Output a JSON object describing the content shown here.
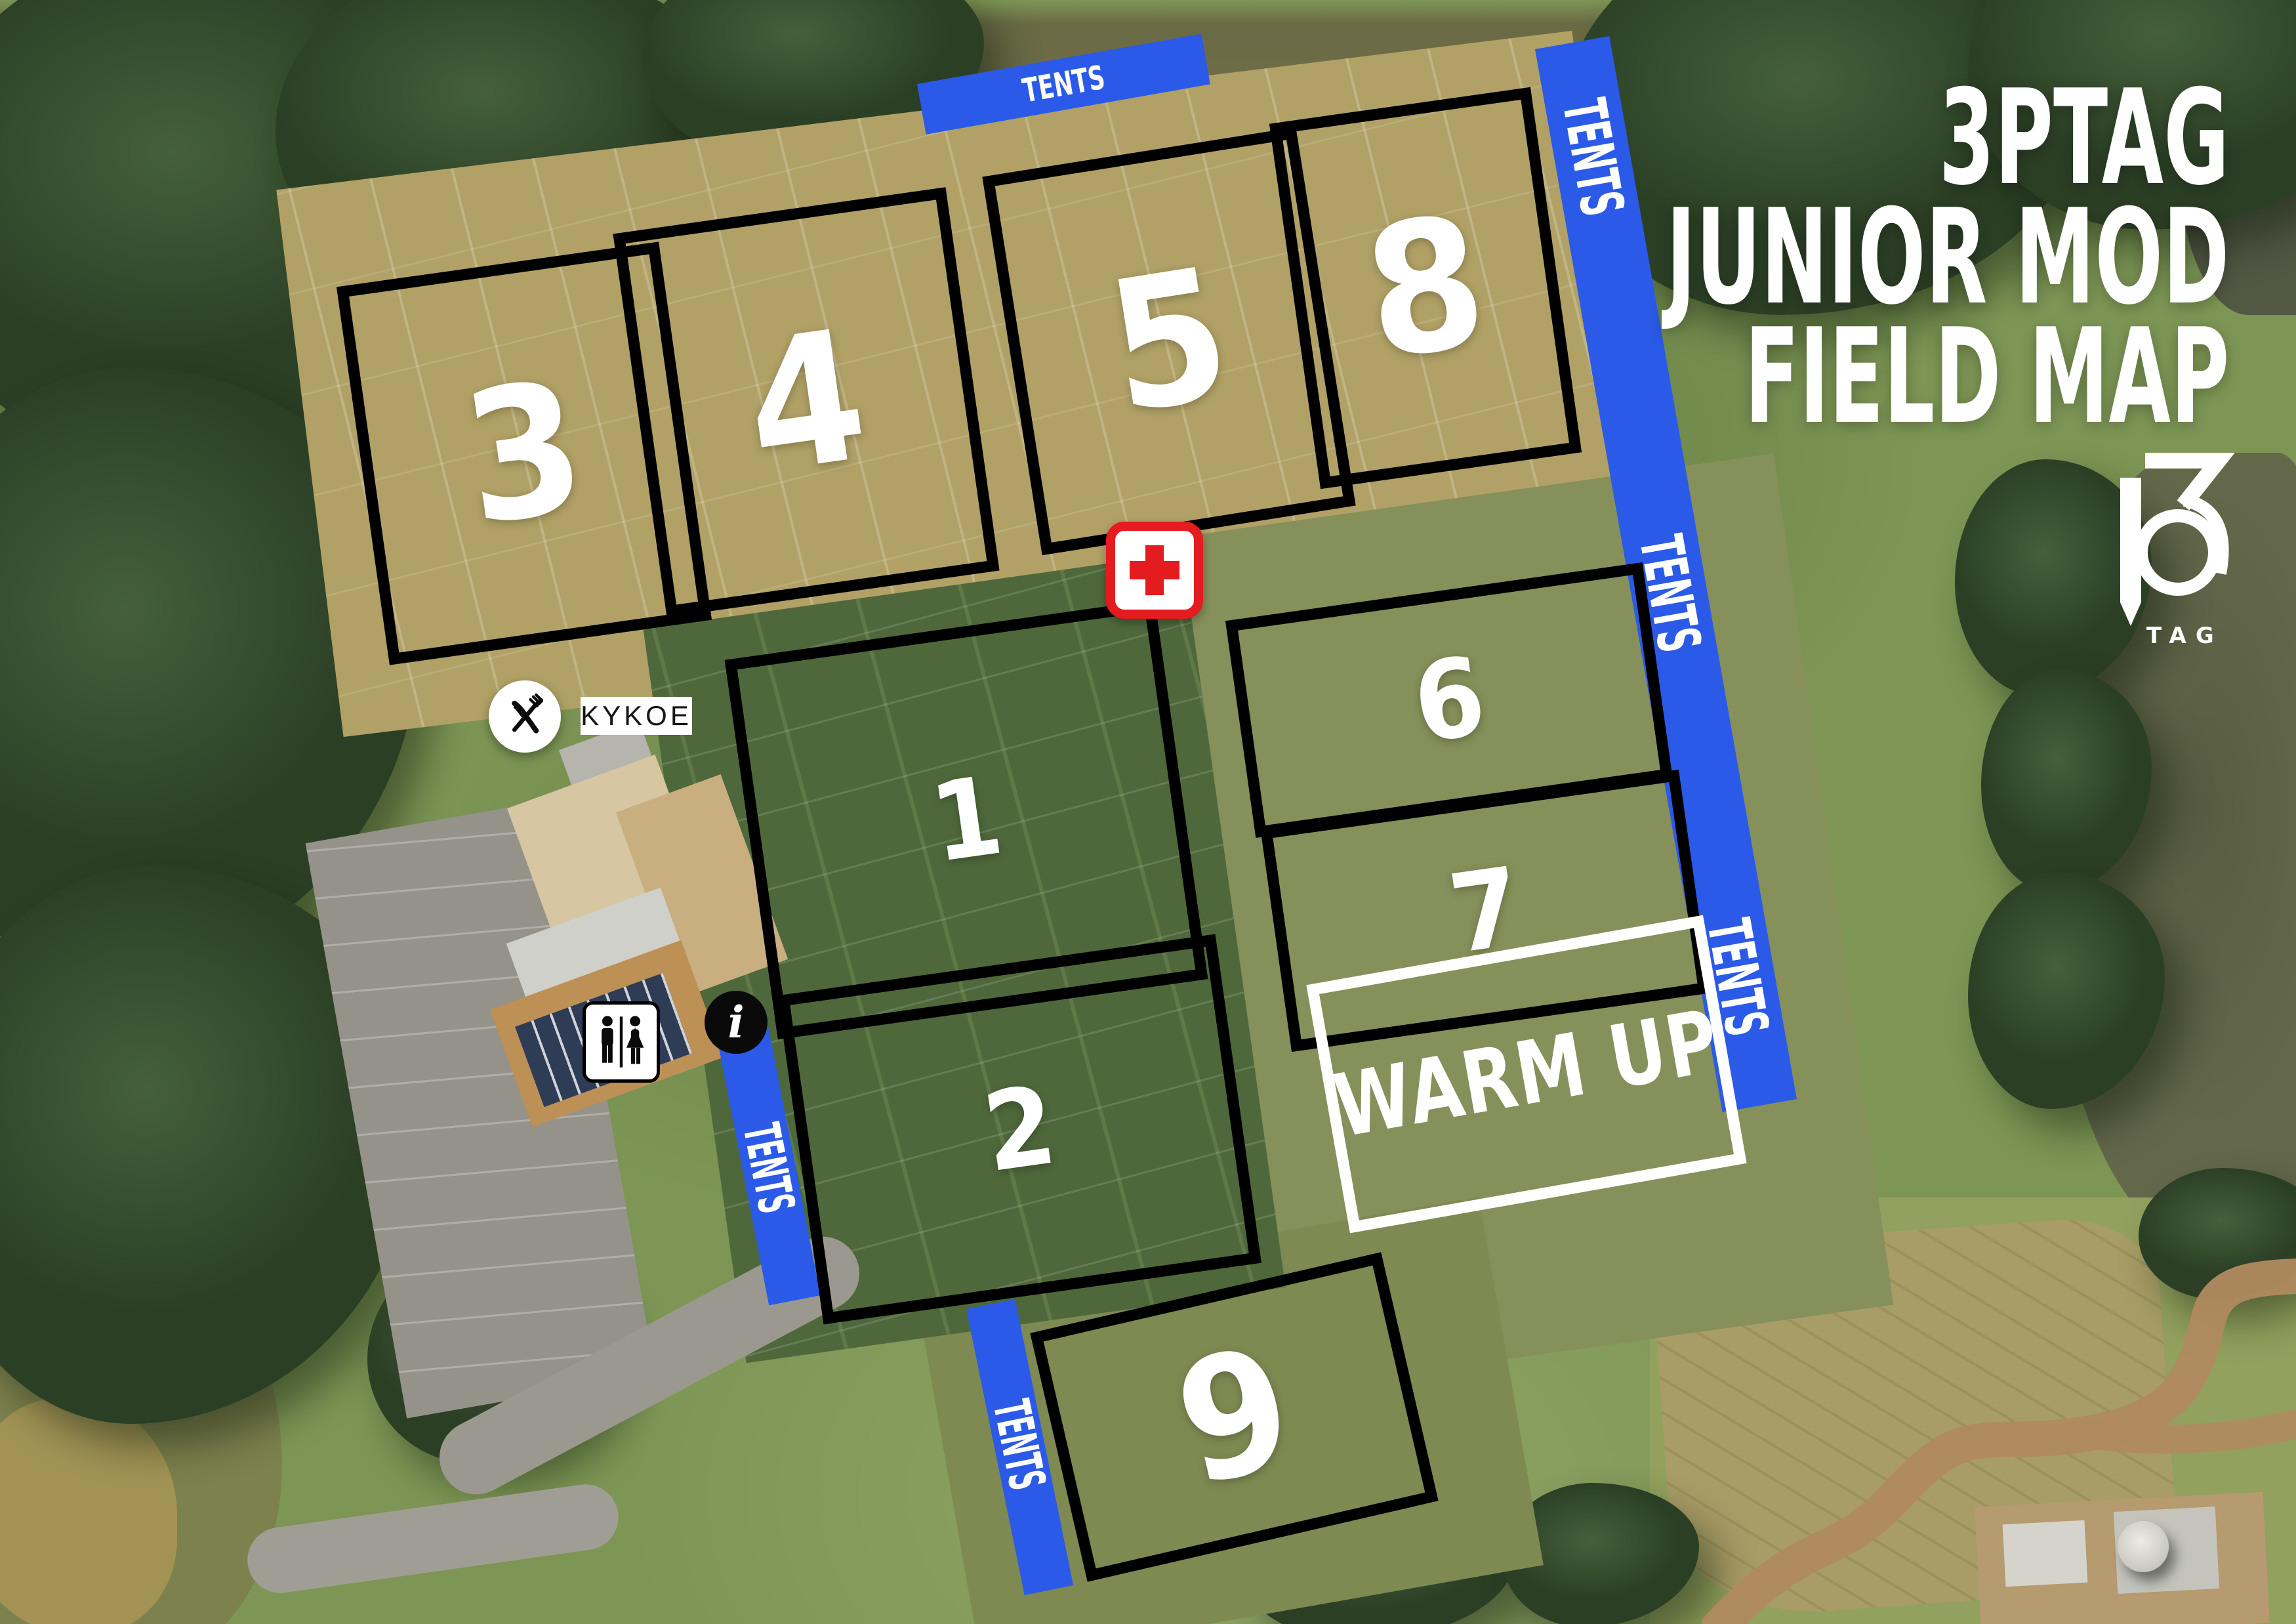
{
  "title": {
    "line1": "3PTAG",
    "line2": "JUNIOR MOD",
    "line3": "FIELD MAP"
  },
  "logo": {
    "number": "3",
    "sub": "TAG"
  },
  "fields": [
    {
      "label": "1"
    },
    {
      "label": "2"
    },
    {
      "label": "3"
    },
    {
      "label": "4"
    },
    {
      "label": "5"
    },
    {
      "label": "6"
    },
    {
      "label": "7"
    },
    {
      "label": "8"
    },
    {
      "label": "9"
    }
  ],
  "warmup": {
    "label": "WARM UP"
  },
  "strips": {
    "top": {
      "label": "TENTS"
    },
    "right": {
      "labels": [
        "TENTS",
        "TENTS",
        "TENTS"
      ]
    },
    "left": {
      "label": "TENTS"
    },
    "bottom": {
      "label": "TENTS"
    }
  },
  "pois": {
    "food_vendor": {
      "icon": "fork-knife-icon",
      "label": "KYKOE"
    },
    "restrooms": {
      "icon": "restrooms-icon"
    },
    "info": {
      "icon": "info-icon",
      "glyph": "i"
    },
    "first_aid": {
      "icon": "first-aid-cross-icon"
    }
  },
  "colors": {
    "tents_blue": "#2B5AE8",
    "field_outline_black": "#000000",
    "warmup_outline_white": "#FFFFFF",
    "first_aid_red": "#E41B1F",
    "title_white": "#FFFFFF"
  }
}
